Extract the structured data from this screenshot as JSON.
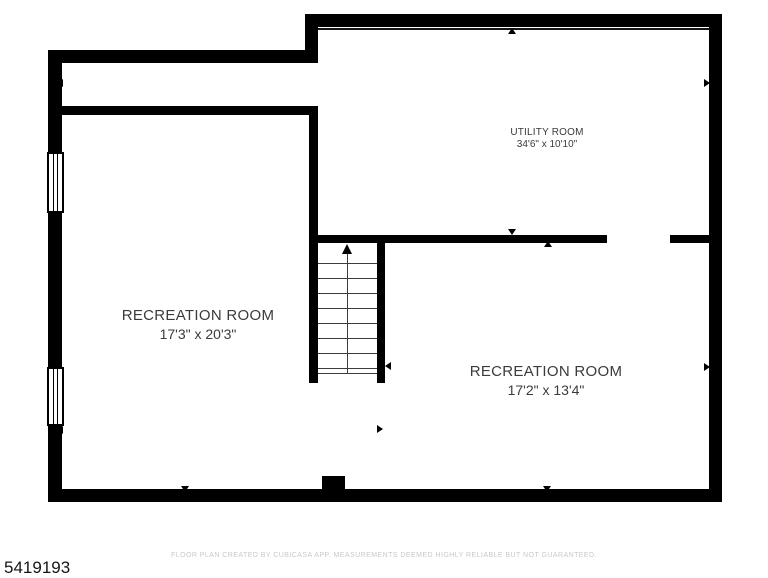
{
  "plan": {
    "wall_color": "#000000",
    "background": "#ffffff",
    "rooms": [
      {
        "id": "utility-room",
        "name": "UTILITY ROOM",
        "dimensions": "34'6\" x 10'10\""
      },
      {
        "id": "recreation-room-left",
        "name": "RECREATION ROOM",
        "dimensions": "17'3\" x 20'3\""
      },
      {
        "id": "recreation-room-right",
        "name": "RECREATION ROOM",
        "dimensions": "17'2\" x 13'4\""
      }
    ],
    "features": [
      "stairs-up-arrow",
      "window",
      "window",
      "chimney",
      "door-opening"
    ]
  },
  "footer": {
    "listing_id": "5419193",
    "disclaimer": "FLOOR PLAN CREATED BY CUBICASA APP. MEASUREMENTS DEEMED HIGHLY RELIABLE BUT NOT GUARANTEED."
  }
}
